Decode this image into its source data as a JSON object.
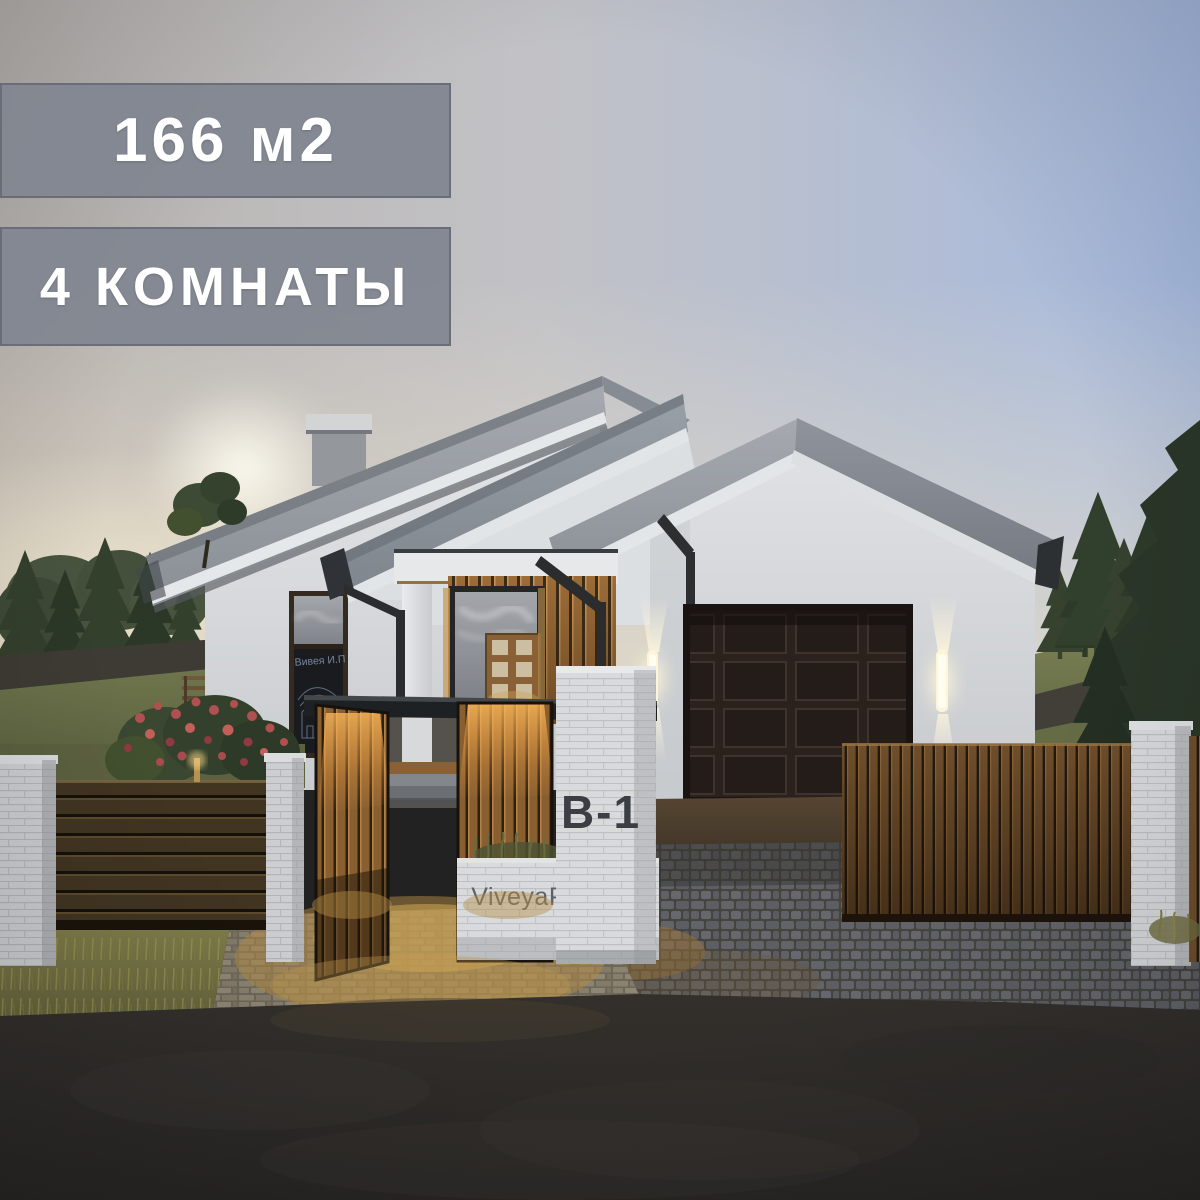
{
  "overlay": {
    "area_badge": "166 м2",
    "rooms_badge": "4 КОМНАТЫ"
  },
  "scene": {
    "house_number": "B-1",
    "watermark": "ViveyaProekt.ru",
    "window_sign": "Вивея И.П",
    "colors": {
      "badge_bg": "#81868f",
      "badge_text": "#ffffff",
      "sky_blue": "#a6badf",
      "sky_warm": "#e9dfca",
      "roof_gray": "#9aa0a7",
      "wall_white": "#e2e4e6",
      "wood_accent": "#a9743c",
      "garage_door": "#241c19",
      "house_number_color": "#3b3e42",
      "watermark_color": "#5d6064",
      "lamp_glow": "#fff3cf"
    }
  }
}
